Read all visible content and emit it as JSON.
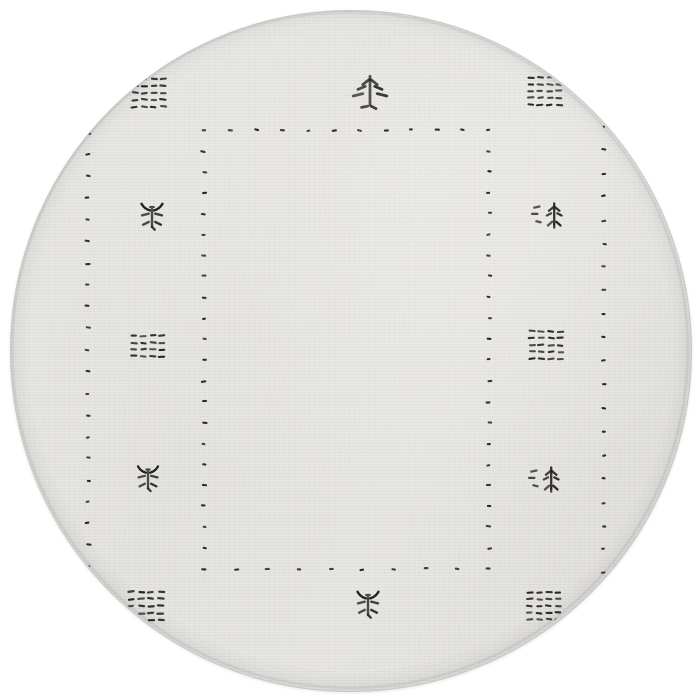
{
  "scene": {
    "description": "Round ivory Gabbeh-style wool area rug, top view, on a white background. Minimalist charcoal pictograph motifs: pine trees, horned goat figures, small grids of dashes, framed by dotted-line borders.",
    "shape": "circle"
  },
  "colors": {
    "page_background": "#ffffff",
    "rug_base": "#e4e3e1",
    "rug_shade": "#dedddb",
    "rug_highlight": "#eceae8",
    "rug_edge": "#c7c6c3",
    "motif_ink": "#24231f"
  },
  "rug": {
    "cx": 350,
    "cy": 350,
    "radius": 340
  },
  "dotted_lines": [
    {
      "name": "outer-left-column",
      "orient": "v",
      "x": 88,
      "y1": 133,
      "y2": 567,
      "spacing": 21.7
    },
    {
      "name": "outer-right-column",
      "orient": "v",
      "x": 604,
      "y1": 126,
      "y2": 573,
      "spacing": 23.5
    },
    {
      "name": "inner-top-row",
      "orient": "h",
      "y": 130,
      "x1": 204,
      "x2": 489,
      "spacing": 25.9
    },
    {
      "name": "inner-bottom-row",
      "orient": "h",
      "y": 569,
      "x1": 204,
      "x2": 489,
      "spacing": 31.6
    },
    {
      "name": "inner-left-column",
      "orient": "v",
      "x": 204,
      "y1": 151,
      "y2": 548,
      "spacing": 21.0
    },
    {
      "name": "inner-right-column",
      "orient": "v",
      "x": 489,
      "y1": 151,
      "y2": 548,
      "spacing": 21.0
    }
  ],
  "motifs": [
    {
      "type": "grid-dashes",
      "name": "hash-top-left",
      "cx": 149,
      "cy": 93,
      "rows": 5,
      "cols": 4,
      "scale": 1.0
    },
    {
      "type": "tree",
      "name": "tree-top-center",
      "cx": 370,
      "cy": 93,
      "scale": 1.2
    },
    {
      "type": "grid-dashes",
      "name": "hash-top-right",
      "cx": 545,
      "cy": 91,
      "rows": 5,
      "cols": 4,
      "scale": 1.0
    },
    {
      "type": "goat",
      "name": "goat-left-upper",
      "cx": 152,
      "cy": 217,
      "scale": 1.1
    },
    {
      "type": "tree-dashes",
      "name": "figure-right-upper",
      "cx": 550,
      "cy": 216,
      "scale": 1.05
    },
    {
      "type": "grid-dashes",
      "name": "hash-left-middle",
      "cx": 148,
      "cy": 346,
      "rows": 4,
      "cols": 4,
      "scale": 1.0
    },
    {
      "type": "grid-dashes",
      "name": "hash-right-middle",
      "cx": 546,
      "cy": 345,
      "rows": 5,
      "cols": 4,
      "scale": 1.0
    },
    {
      "type": "goat",
      "name": "goat-left-lower",
      "cx": 148,
      "cy": 479,
      "scale": 1.05
    },
    {
      "type": "tree-dashes",
      "name": "figure-right-lower",
      "cx": 547,
      "cy": 480,
      "scale": 1.05
    },
    {
      "type": "grid-dashes",
      "name": "hash-bottom-left",
      "cx": 146,
      "cy": 606,
      "rows": 5,
      "cols": 4,
      "scale": 1.05
    },
    {
      "type": "goat",
      "name": "goat-bottom-center",
      "cx": 368,
      "cy": 605,
      "scale": 1.1
    },
    {
      "type": "grid-dashes",
      "name": "hash-bottom-right",
      "cx": 544,
      "cy": 606,
      "rows": 5,
      "cols": 4,
      "scale": 1.0
    }
  ]
}
